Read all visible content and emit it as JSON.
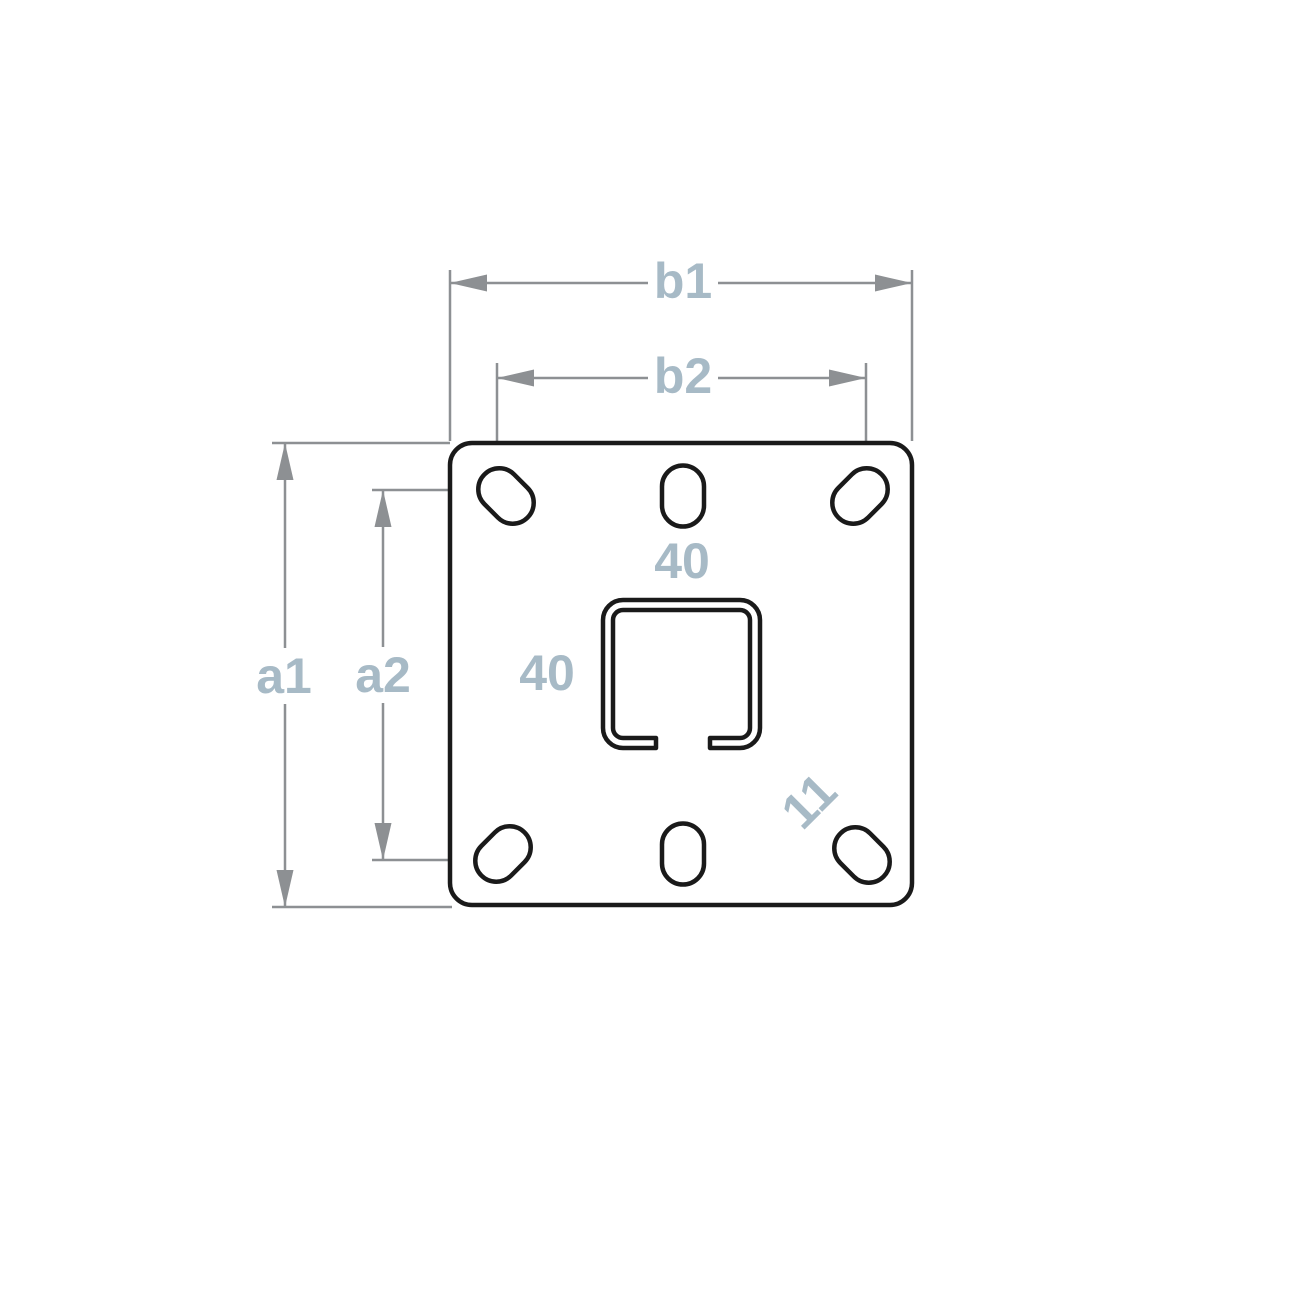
{
  "diagram": {
    "title": "Wall plate with square tube profile - dimension drawing",
    "colors": {
      "background": "#ffffff",
      "outline": "#1a1a1a",
      "dimension": "#8d9093",
      "label": "#a7bac6"
    },
    "part": {
      "plate": "square plate with rounded corners",
      "holes": "six obround slots, corner slots rotated 45 degrees, middle slots vertical",
      "profile": "square C-channel tube cross-section, open at bottom"
    },
    "dimensions": [
      {
        "label": "b1",
        "orientation": "horizontal",
        "measures": "overall plate width"
      },
      {
        "label": "b2",
        "orientation": "horizontal",
        "measures": "horizontal slot spacing"
      },
      {
        "label": "a1",
        "orientation": "vertical",
        "measures": "overall plate height"
      },
      {
        "label": "a2",
        "orientation": "vertical",
        "measures": "vertical slot spacing"
      },
      {
        "label": "40",
        "orientation": "horizontal",
        "measures": "tube outer width"
      },
      {
        "label": "40",
        "orientation": "vertical",
        "measures": "tube outer height"
      },
      {
        "label": "11",
        "orientation": "diagonal",
        "measures": "slot width"
      }
    ]
  }
}
